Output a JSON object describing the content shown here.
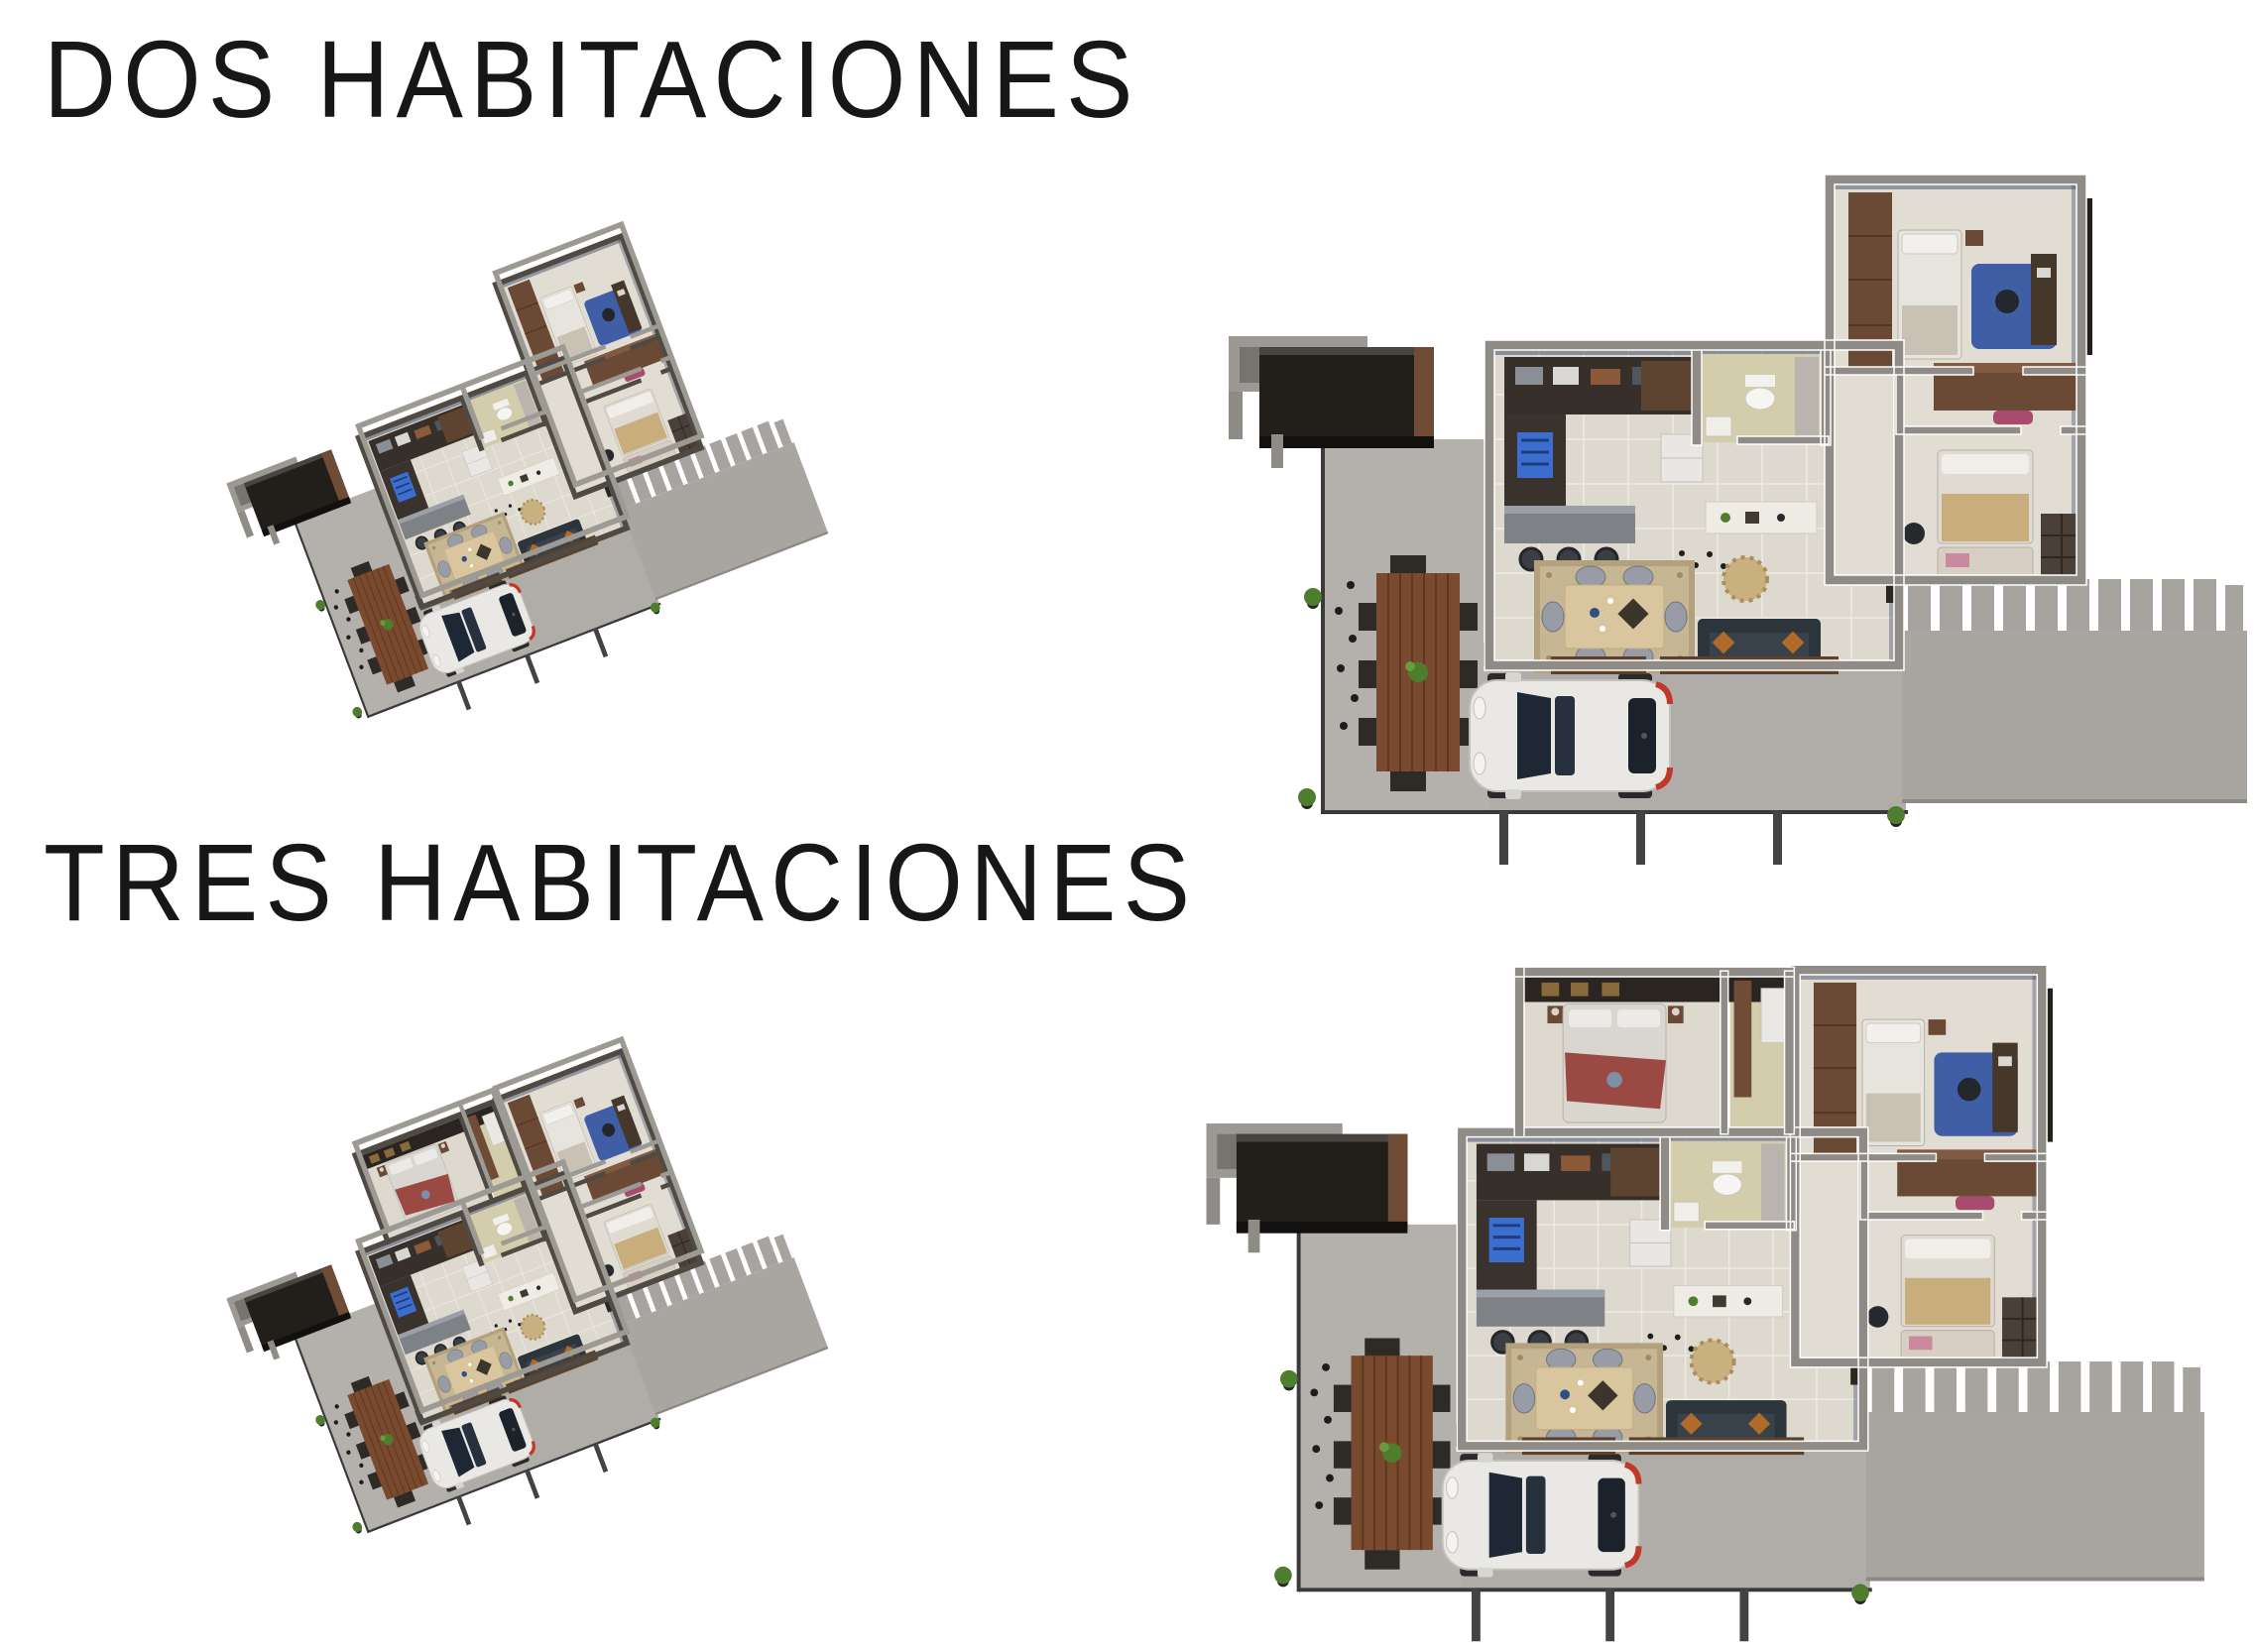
{
  "page": {
    "background": "#ffffff",
    "language": "es"
  },
  "sections": [
    {
      "title": "DOS HABITACIONES",
      "bedrooms": 2,
      "views": [
        {
          "name": "isometric-view",
          "label": "Plano 3D isometrico - dos habitaciones"
        },
        {
          "name": "top-down-view",
          "label": "Plano 3D cenital - dos habitaciones"
        }
      ]
    },
    {
      "title": "TRES HABITACIONES",
      "bedrooms": 3,
      "views": [
        {
          "name": "isometric-view",
          "label": "Plano 3D isometrico - tres habitaciones"
        },
        {
          "name": "top-down-view",
          "label": "Plano 3D cenital - tres habitaciones"
        }
      ]
    }
  ],
  "palette": {
    "title_text": "#171717",
    "concrete_patio": "#b2afaa",
    "concrete_pad": "#a9a6a1",
    "wall_top": "#8f8c87",
    "wall_side": "#4f4a44",
    "floor_cream": "#ded9cf",
    "floor_bath": "#d3cdac",
    "wood_dark": "#6b4a35",
    "wood_outdoor_table": "#7a4a2e",
    "wood_dining_table": "#d9c59e",
    "rug_tan": "#c7b694",
    "sofa_slate": "#39424a",
    "pillow_orange": "#b06a2a",
    "car_body": "#e9e8e4",
    "glass_dark": "#20293a",
    "stove_blue": "#3c6ed0",
    "office_rug_blue": "#3f5ea6",
    "chair_pink": "#bd5a80",
    "blanket_red": "#9a4a42",
    "blanket_tan": "#c8ae7c",
    "pergola_dark": "#221e1a",
    "plant_green": "#4e7d2d",
    "tail_red": "#c03828"
  }
}
